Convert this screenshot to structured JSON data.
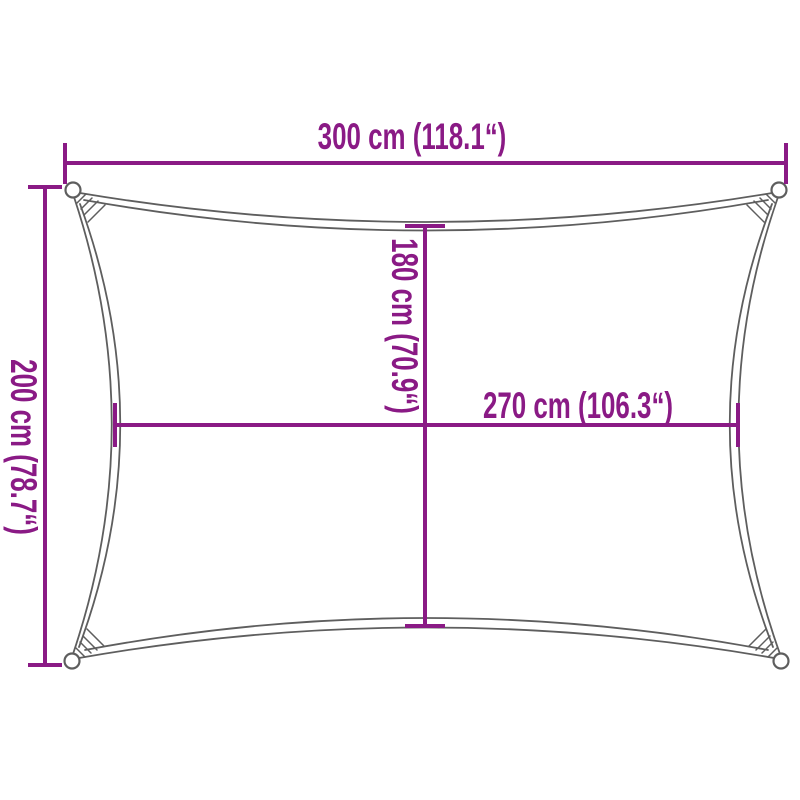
{
  "diagram": {
    "title": "Rectangular shade sail dimension diagram",
    "background_color": "#ffffff",
    "accent_color": "#8a1a85",
    "outline_color": "#5e5e5e",
    "shape": "rectangle with concave edges and corner fixing loops",
    "dimensions": {
      "top_width": {
        "label": "300 cm (118.1“)",
        "value_cm": 300,
        "value_in": 118.1,
        "orientation": "horizontal"
      },
      "left_height": {
        "label": "200 cm (78.7“)",
        "value_cm": 200,
        "value_in": 78.7,
        "orientation": "vertical"
      },
      "center_height": {
        "label": "180 cm (70.9“)",
        "value_cm": 180,
        "value_in": 70.9,
        "orientation": "vertical"
      },
      "center_width": {
        "label": "270 cm (106.3“)",
        "value_cm": 270,
        "value_in": 106.3,
        "orientation": "horizontal"
      }
    }
  }
}
